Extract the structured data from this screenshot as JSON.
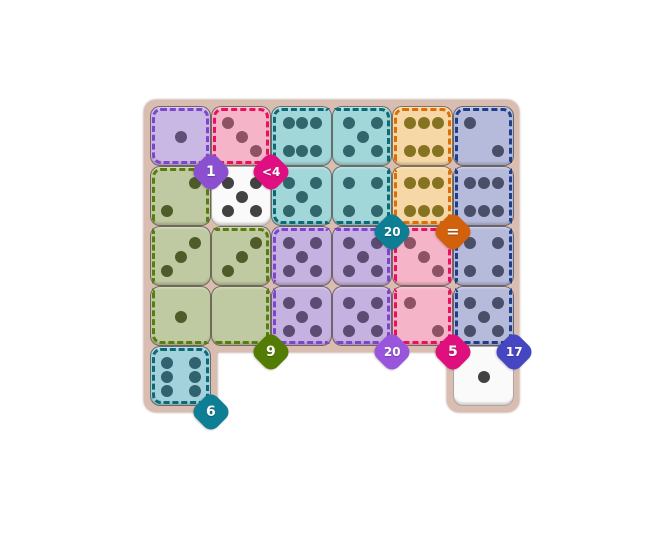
{
  "app": {
    "background_color": "#ffffff"
  },
  "board": {
    "frame_color": "#d9bdb1",
    "grid": {
      "cols": 6,
      "rows": 5
    },
    "regions": {
      "lavender": {
        "fill": "#c9b8e4",
        "stroke": "#7e44cc",
        "pip_color": "#5e5175"
      },
      "rose": {
        "fill": "#f6b4c9",
        "stroke": "#e8115e",
        "pip_color": "#8d5266"
      },
      "teal": {
        "fill": "#a2d7d9",
        "stroke": "#0c6a76",
        "pip_color": "#31666c"
      },
      "orange": {
        "fill": "#f5d8a6",
        "stroke": "#e06c04",
        "pip_color": "#867322"
      },
      "periwinkle": {
        "fill": "#b6bbdb",
        "stroke": "#1d3e88",
        "pip_color": "#4a4f69"
      },
      "green": {
        "fill": "#bfcaa2",
        "stroke": "#587c0e",
        "pip_color": "#4e5c2a"
      },
      "purple": {
        "fill": "#c5b2e0",
        "stroke": "#7e44cc",
        "pip_color": "#5c4b73"
      },
      "pink": {
        "fill": "#f6b4c9",
        "stroke": "#e8115e",
        "pip_color": "#8d5266"
      },
      "cyan": {
        "fill": "#a4d2dc",
        "stroke": "#0c6a76",
        "pip_color": "#30626f"
      },
      "white": {
        "fill": "#fafafa",
        "stroke": "none",
        "pip_color": "#424242"
      }
    },
    "dice": [
      {
        "col": 0,
        "row": 0,
        "region": "lavender",
        "value": 1,
        "pips": [
          "c"
        ]
      },
      {
        "col": 1,
        "row": 0,
        "region": "rose",
        "value": 3,
        "pips": [
          "tl",
          "c",
          "br"
        ]
      },
      {
        "col": 2,
        "row": 0,
        "region": "teal",
        "value": 6,
        "pips": [
          "tl",
          "tm",
          "tr",
          "bl",
          "bm",
          "br"
        ]
      },
      {
        "col": 3,
        "row": 0,
        "region": "teal",
        "value": 5,
        "pips": [
          "tl",
          "tr",
          "c",
          "bl",
          "br"
        ]
      },
      {
        "col": 4,
        "row": 0,
        "region": "orange",
        "value": 6,
        "pips": [
          "tl",
          "tm",
          "tr",
          "bl",
          "bm",
          "br"
        ]
      },
      {
        "col": 5,
        "row": 0,
        "region": "periwinkle",
        "value": 2,
        "pips": [
          "tl",
          "br"
        ]
      },
      {
        "col": 0,
        "row": 1,
        "region": "green",
        "value": 2,
        "pips": [
          "tr",
          "bl"
        ]
      },
      {
        "col": 1,
        "row": 1,
        "region": "white",
        "value": 5,
        "pips": [
          "tl",
          "tr",
          "c",
          "bl",
          "br"
        ]
      },
      {
        "col": 2,
        "row": 1,
        "region": "teal",
        "value": 5,
        "pips": [
          "tl",
          "tr",
          "c",
          "bl",
          "br"
        ]
      },
      {
        "col": 3,
        "row": 1,
        "region": "teal",
        "value": 4,
        "pips": [
          "tl",
          "tr",
          "bl",
          "br"
        ]
      },
      {
        "col": 4,
        "row": 1,
        "region": "orange",
        "value": 6,
        "pips": [
          "tl",
          "tm",
          "tr",
          "bl",
          "bm",
          "br"
        ]
      },
      {
        "col": 5,
        "row": 1,
        "region": "periwinkle",
        "value": 6,
        "pips": [
          "tl",
          "tm",
          "tr",
          "bl",
          "bm",
          "br"
        ]
      },
      {
        "col": 0,
        "row": 2,
        "region": "green",
        "value": 3,
        "pips": [
          "tr",
          "c",
          "bl"
        ]
      },
      {
        "col": 1,
        "row": 2,
        "region": "green",
        "value": 3,
        "pips": [
          "tr",
          "c",
          "bl"
        ]
      },
      {
        "col": 2,
        "row": 2,
        "region": "purple",
        "value": 5,
        "pips": [
          "tl",
          "tr",
          "c",
          "bl",
          "br"
        ]
      },
      {
        "col": 3,
        "row": 2,
        "region": "purple",
        "value": 5,
        "pips": [
          "tl",
          "tr",
          "c",
          "bl",
          "br"
        ]
      },
      {
        "col": 4,
        "row": 2,
        "region": "pink",
        "value": 3,
        "pips": [
          "tl",
          "c",
          "br"
        ]
      },
      {
        "col": 5,
        "row": 2,
        "region": "periwinkle",
        "value": 4,
        "pips": [
          "tl",
          "tr",
          "bl",
          "br"
        ]
      },
      {
        "col": 0,
        "row": 3,
        "region": "green",
        "value": 1,
        "pips": [
          "c"
        ]
      },
      {
        "col": 1,
        "row": 3,
        "region": "green",
        "value": 0,
        "pips": []
      },
      {
        "col": 2,
        "row": 3,
        "region": "purple",
        "value": 5,
        "pips": [
          "tl",
          "tr",
          "c",
          "bl",
          "br"
        ]
      },
      {
        "col": 3,
        "row": 3,
        "region": "purple",
        "value": 5,
        "pips": [
          "tl",
          "tr",
          "c",
          "bl",
          "br"
        ]
      },
      {
        "col": 4,
        "row": 3,
        "region": "pink",
        "value": 2,
        "pips": [
          "tl",
          "br"
        ]
      },
      {
        "col": 5,
        "row": 3,
        "region": "periwinkle",
        "value": 5,
        "pips": [
          "tl",
          "tr",
          "c",
          "bl",
          "br"
        ]
      },
      {
        "col": 0,
        "row": 4,
        "region": "cyan",
        "value": 6,
        "pips": [
          "tl",
          "tr",
          "ml",
          "mr",
          "bl",
          "br"
        ]
      },
      {
        "col": 5,
        "row": 4,
        "region": "white",
        "value": 1,
        "pips": [
          "c"
        ]
      }
    ],
    "badges": [
      {
        "label": "1",
        "color": "#8b50cf",
        "anchor_col": 0,
        "anchor_row": 0
      },
      {
        "label": "<4",
        "color": "#df0f81",
        "anchor_col": 1,
        "anchor_row": 0
      },
      {
        "label": "20",
        "color": "#0d7e94",
        "anchor_col": 3,
        "anchor_row": 1
      },
      {
        "label": "=",
        "color": "#d2610e",
        "anchor_col": 4,
        "anchor_row": 1
      },
      {
        "label": "9",
        "color": "#527c03",
        "anchor_col": 1,
        "anchor_row": 3
      },
      {
        "label": "20",
        "color": "#9956dc",
        "anchor_col": 3,
        "anchor_row": 3
      },
      {
        "label": "5",
        "color": "#df0f7d",
        "anchor_col": 4,
        "anchor_row": 3
      },
      {
        "label": "17",
        "color": "#4646c2",
        "anchor_col": 5,
        "anchor_row": 3
      },
      {
        "label": "6",
        "color": "#0d7e94",
        "anchor_col": 0,
        "anchor_row": 4
      }
    ]
  }
}
